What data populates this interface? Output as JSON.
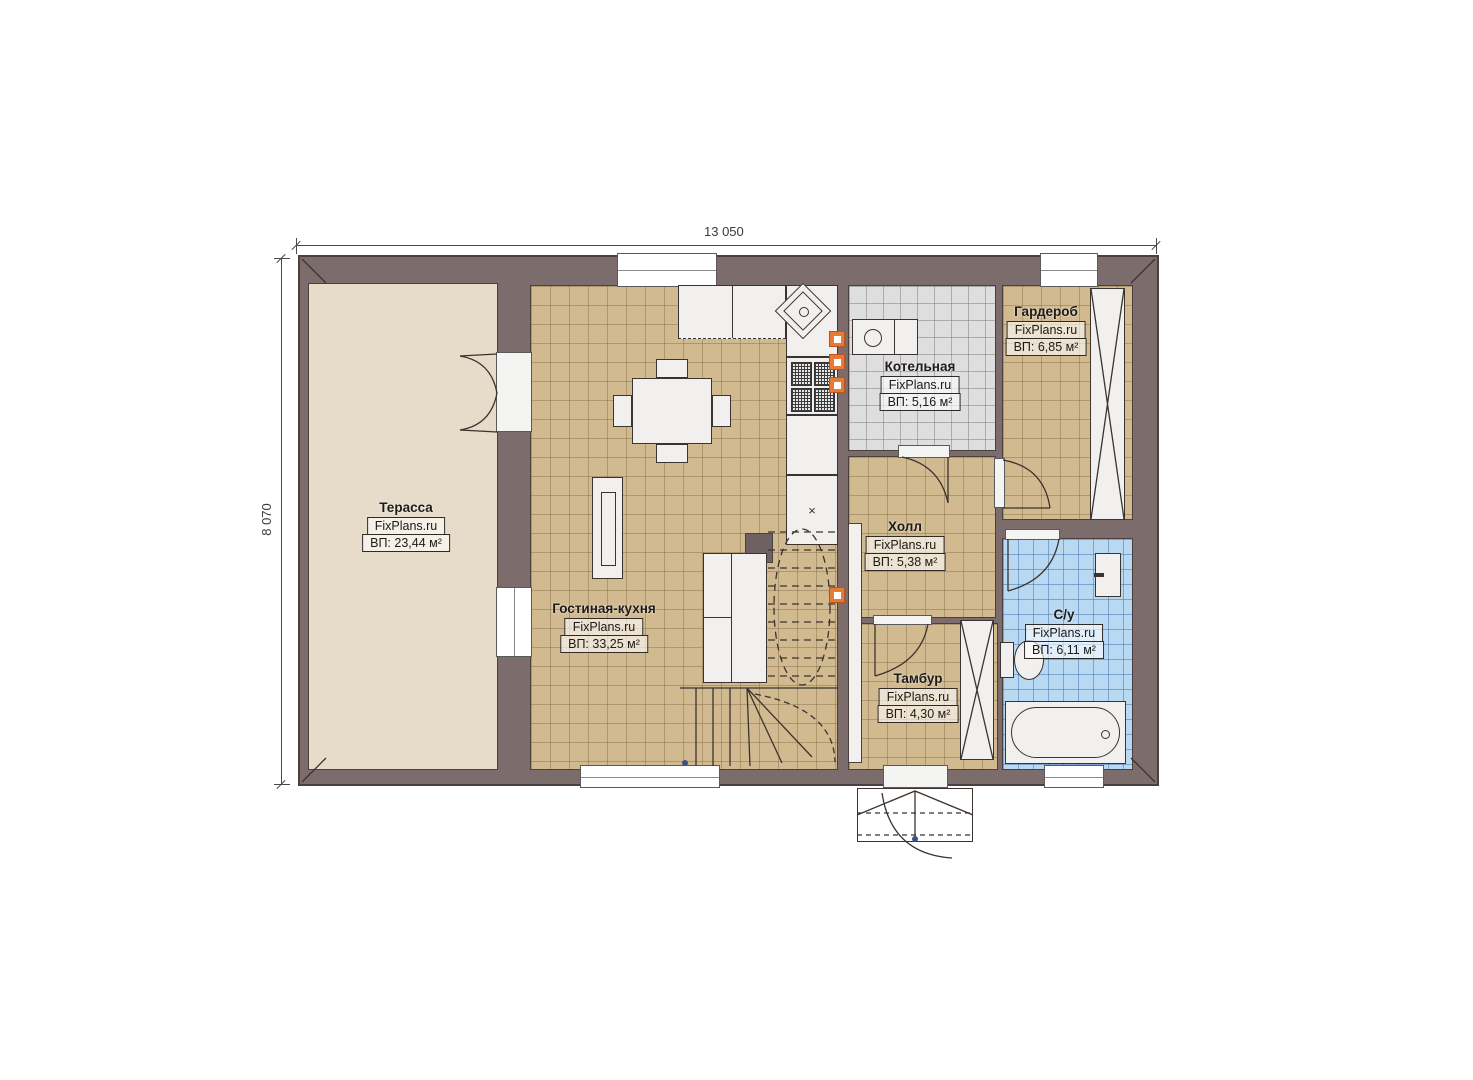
{
  "plan": {
    "type": "floor-plan",
    "brand": "FixPlans.ru",
    "dimensions": {
      "width_label": "13 050",
      "height_label": "8 070"
    }
  },
  "rooms": [
    {
      "id": "terrace",
      "name": "Терасса",
      "brand": "FixPlans.ru",
      "area": "ВП: 23,44 м²"
    },
    {
      "id": "living-kitchen",
      "name": "Гостиная-кухня",
      "brand": "FixPlans.ru",
      "area": "ВП: 33,25 м²"
    },
    {
      "id": "boiler-room",
      "name": "Котельная",
      "brand": "FixPlans.ru",
      "area": "ВП: 5,16 м²"
    },
    {
      "id": "wardrobe",
      "name": "Гардероб",
      "brand": "FixPlans.ru",
      "area": "ВП: 6,85 м²"
    },
    {
      "id": "hall",
      "name": "Холл",
      "brand": "FixPlans.ru",
      "area": "ВП: 5,38 м²"
    },
    {
      "id": "bathroom",
      "name": "С/у",
      "brand": "FixPlans.ru",
      "area": "ВП: 6,11 м²"
    },
    {
      "id": "vestibule",
      "name": "Тамбур",
      "brand": "FixPlans.ru",
      "area": "ВП: 4,30 м²"
    }
  ],
  "colors": {
    "wall": "#7d6c6c",
    "terrace_floor": "#e7dcc9",
    "tile_tan": "#d2ba90",
    "tile_gray": "#dedede",
    "tile_blue": "#b9d8f2",
    "accent_orange": "#e87a33",
    "line": "#3a332f"
  }
}
